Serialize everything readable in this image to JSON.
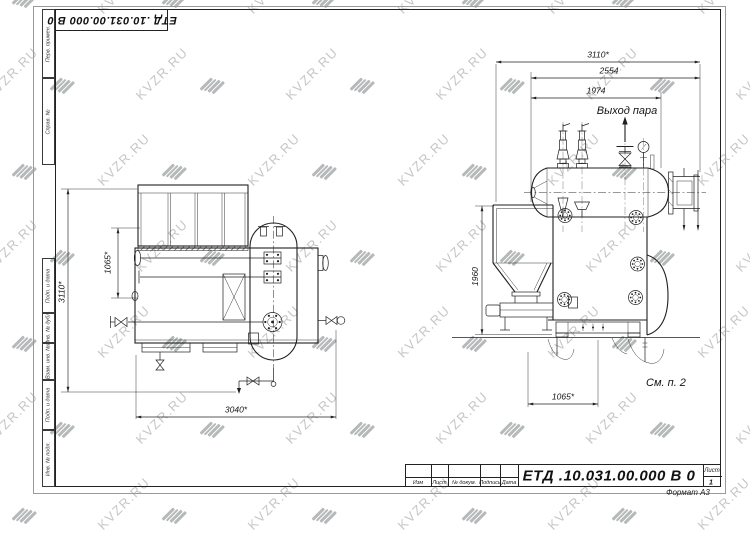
{
  "page": {
    "designation": "ЕТД .10.031.00.000  В 0",
    "format_label": "Формат А3",
    "sheet_label": "Лист",
    "sheet_number": "1",
    "title_block_columns": [
      "Изм",
      "Лист",
      "№ докум.",
      "Подпись",
      "Дата"
    ],
    "side_stamps": [
      "Перв. примен.",
      "Справ. №",
      "Подп. и дата",
      "Инв. № дубл.",
      "Взам. инв. №",
      "Подп. и дата",
      "Инв. № подл."
    ]
  },
  "watermark": {
    "text": "KVZR.RU"
  },
  "views": {
    "plan": {
      "dims": {
        "overall_height": "3110*",
        "drum_offset": "1065*",
        "overall_length": "3040*"
      }
    },
    "side": {
      "dims": {
        "overall_length": "3110*",
        "body_length": "2554",
        "drum_length": "1974",
        "height": "1960",
        "support_span": "1065*"
      },
      "labels": {
        "steam_outlet": "Выход пара",
        "see_note": "См. п. 2"
      }
    }
  }
}
